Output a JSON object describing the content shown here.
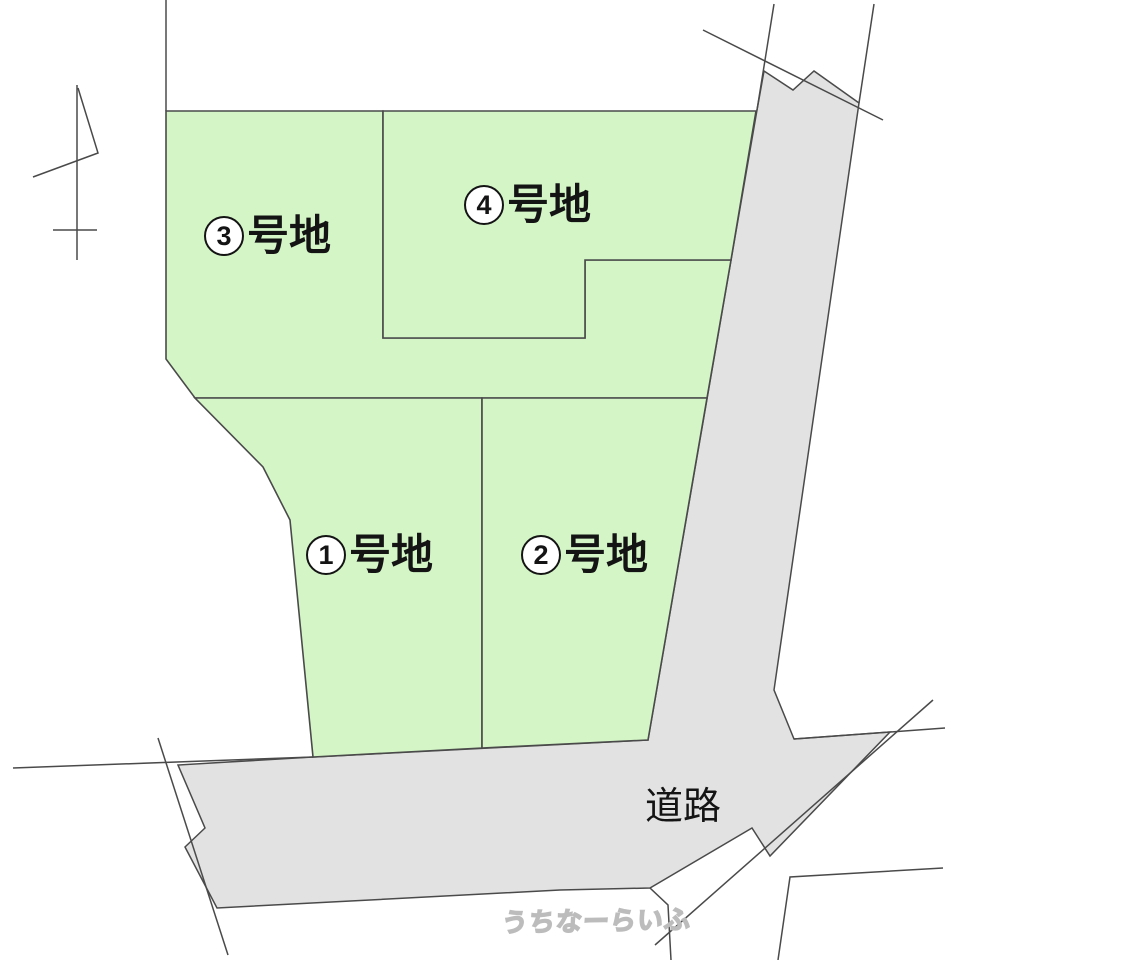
{
  "page": {
    "type": "land-subdivision-plan"
  },
  "colors": {
    "plot_fill": "#d4f6c6",
    "road_fill": "#e2e2e2",
    "line_color": "#4a4a4a",
    "label_color": "#141414",
    "watermark_fill": "#ffffff",
    "watermark_outline": "#bcbcbc"
  },
  "plots": [
    {
      "number": "1",
      "suffix": "号地",
      "label": "①号地"
    },
    {
      "number": "2",
      "suffix": "号地",
      "label": "②号地"
    },
    {
      "number": "3",
      "suffix": "号地",
      "label": "③号地"
    },
    {
      "number": "4",
      "suffix": "号地",
      "label": "④号地"
    }
  ],
  "road": {
    "label": "道路"
  },
  "watermark": {
    "text": "うちなーらいふ"
  }
}
